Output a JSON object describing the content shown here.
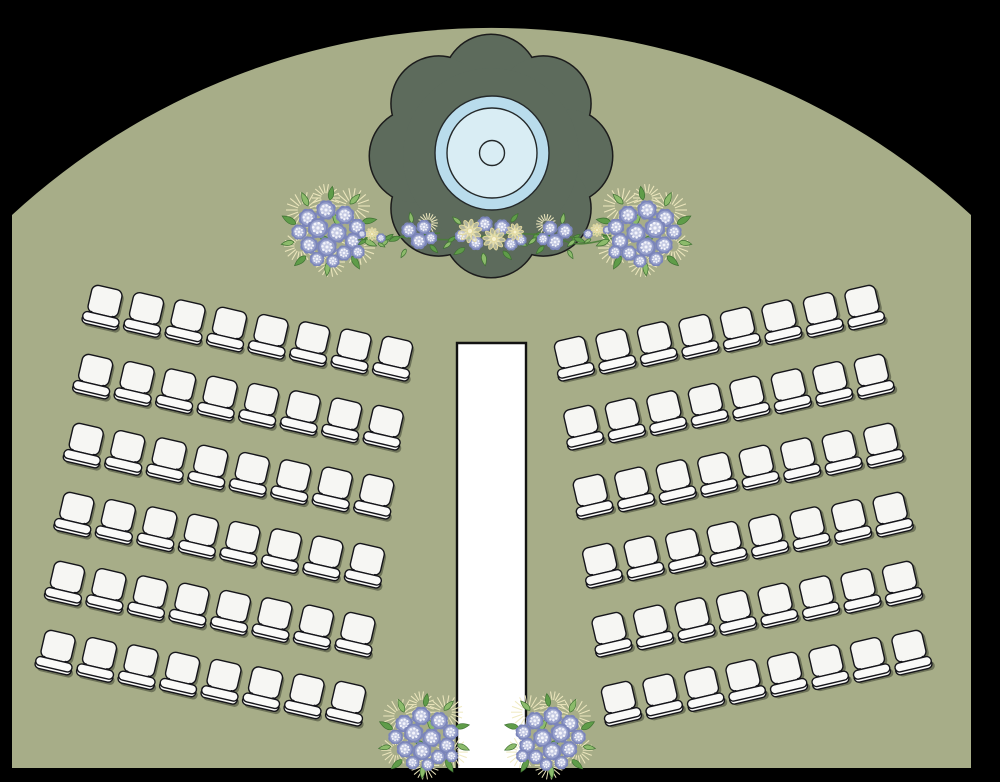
{
  "app": {
    "title": "Wedding Ceremony Seating Chart",
    "description": "Arched outdoor ceremony floor plan with flower-shaped stage, center aisle and two arced guest seating sections"
  },
  "scene": {
    "width": 1000,
    "height": 782,
    "background_color": "#000000"
  },
  "venue": {
    "floor_color": "#a7ad88",
    "left_edge": 12,
    "right_edge": 971,
    "bottom_edge": 768,
    "arch_shoulder_y": 215,
    "arch_apex_y": 28,
    "arch_radius": 708
  },
  "stage": {
    "center_x": 491,
    "center_y": 156,
    "platform_color": "#5d6b5c",
    "outline_color": "#1c1c1c",
    "lobe_count": 8,
    "lobe_radius": 47,
    "lobe_orbit": 74,
    "core_radius": 88,
    "rings": [
      {
        "name": "stage-circle-outer",
        "cx": 492,
        "cy": 153,
        "r": 57,
        "fill": "#b9dcec"
      },
      {
        "name": "stage-circle-inner",
        "cx": 492,
        "cy": 153,
        "r": 45,
        "fill": "#d9edf4"
      },
      {
        "name": "stage-circle-center",
        "cx": 492,
        "cy": 153,
        "r": 12.5,
        "fill": "#d9edf4"
      }
    ]
  },
  "aisle": {
    "x": 457,
    "width": 69,
    "top": 343,
    "bottom": 768,
    "fill": "#ffffff",
    "border_color": "#121212",
    "border_width": 2.4
  },
  "seating": {
    "sections": 2,
    "rows_per_section": 6,
    "chairs_per_row": 8,
    "total_chairs": 96,
    "chair_style": {
      "fill": "#f6f6f3",
      "seat_fill": "#fafaf8",
      "stroke": "#15151a",
      "stroke_width": 1.4,
      "shadow": "rgba(30,35,25,0.42)"
    },
    "left_section": {
      "first_chair_center": {
        "x": 103,
        "y": 310
      },
      "row_step": {
        "x": -9.4,
        "y": 69
      },
      "chair_step": {
        "x": 41.5,
        "y": 7.3
      },
      "rotation_deg": 13
    },
    "right_section": {
      "mirror_of": "left_section",
      "mirror_sum_x": 967,
      "rotation_deg": -13
    }
  },
  "florals": {
    "palette": {
      "petal_dark": "#7b85ba",
      "petal_mid": "#98a1cc",
      "petal_light": "#c6cbe4",
      "petal_dot": "#f4f5fb",
      "leaf_dark": "#3f7233",
      "leaf_mid": "#5f9c49",
      "leaf_light": "#8cbb6b",
      "cream": "#f7f2d2",
      "cream_line": "#e3d99d",
      "burst": "#efe9bf",
      "stem": "#4a7d38"
    },
    "garland_stem": {
      "x1": 352,
      "x2": 630,
      "y": 238
    },
    "garland_leaf_pairs": [
      [
        385,
        240
      ],
      [
        448,
        242
      ],
      [
        533,
        238
      ],
      [
        572,
        240
      ]
    ],
    "clusters": [
      {
        "type": "big",
        "x": 330,
        "y": 230,
        "scale": 1,
        "flip": false,
        "name": "garland-bouquet-left"
      },
      {
        "type": "sprig",
        "x": 372,
        "y": 236,
        "scale": 1,
        "flip": false,
        "name": "garland-sprig-left"
      },
      {
        "type": "mid",
        "x": 418,
        "y": 235,
        "scale": 1,
        "flip": false,
        "name": "garland-cluster-left"
      },
      {
        "type": "centerpiece",
        "x": 491,
        "y": 236,
        "scale": 1,
        "flip": false,
        "name": "garland-centerpiece"
      },
      {
        "type": "mid",
        "x": 556,
        "y": 236,
        "scale": 1,
        "flip": true,
        "name": "garland-cluster-right"
      },
      {
        "type": "sprig",
        "x": 597,
        "y": 232,
        "scale": 1,
        "flip": true,
        "name": "garland-sprig-right"
      },
      {
        "type": "big",
        "x": 643,
        "y": 230,
        "scale": 1,
        "flip": true,
        "name": "garland-bouquet-right"
      },
      {
        "type": "big",
        "x": 425,
        "y": 735,
        "scale": 0.95,
        "flip": false,
        "name": "aisle-bouquet-left"
      },
      {
        "type": "big",
        "x": 549,
        "y": 735,
        "scale": 0.95,
        "flip": true,
        "name": "aisle-bouquet-right"
      }
    ]
  }
}
